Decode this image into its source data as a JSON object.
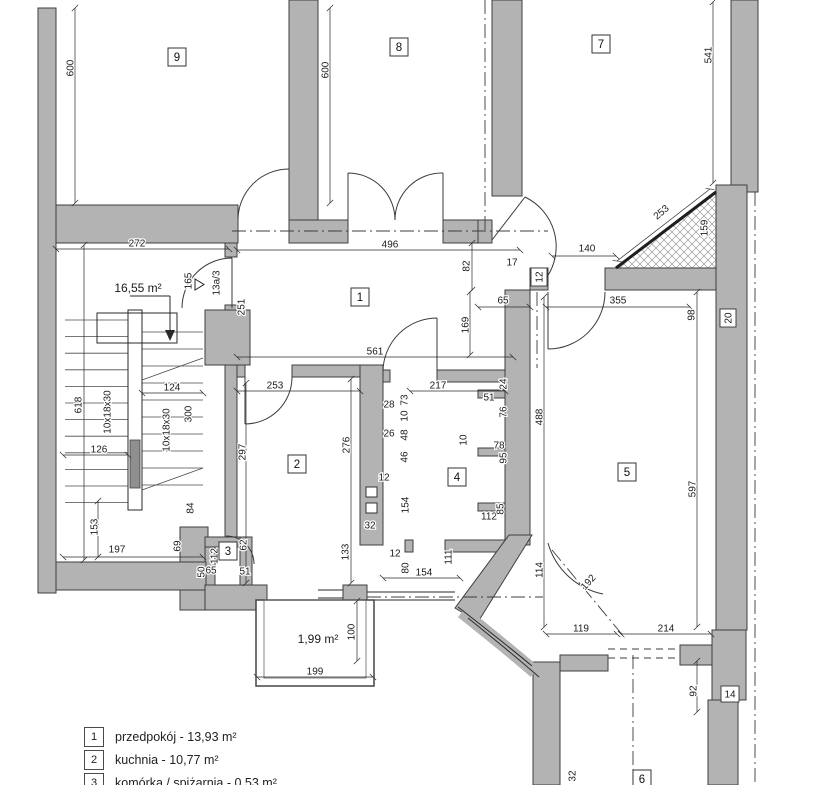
{
  "colors": {
    "wall": "#b3b3b3",
    "wall_outline": "#3f3f3f",
    "line": "#2a2a2a",
    "paper": "#ffffff"
  },
  "areas": [
    {
      "text": "16,55 m²",
      "x": 138,
      "y": 292
    },
    {
      "text": "1,99 m²",
      "x": 318,
      "y": 643
    }
  ],
  "rooms": [
    {
      "num": "9",
      "x": 177,
      "y": 57
    },
    {
      "num": "8",
      "x": 399,
      "y": 47
    },
    {
      "num": "7",
      "x": 601,
      "y": 44
    },
    {
      "num": "1",
      "x": 360,
      "y": 297
    },
    {
      "num": "2",
      "x": 297,
      "y": 464
    },
    {
      "num": "3",
      "x": 228,
      "y": 551
    },
    {
      "num": "4",
      "x": 457,
      "y": 477
    },
    {
      "num": "5",
      "x": 627,
      "y": 472
    },
    {
      "num": "6",
      "x": 642,
      "y": 779
    }
  ],
  "dimensions": [
    {
      "t": "600",
      "x": 70,
      "y": 68,
      "r": -90,
      "line": [
        75,
        8,
        75,
        203
      ]
    },
    {
      "t": "600",
      "x": 325,
      "y": 70,
      "r": -90,
      "line": [
        330,
        8,
        330,
        203
      ]
    },
    {
      "t": "541",
      "x": 708,
      "y": 55,
      "r": -90,
      "line": [
        713,
        2,
        713,
        183
      ]
    },
    {
      "t": "272",
      "x": 137,
      "y": 243,
      "r": 0,
      "line": [
        56,
        249,
        229,
        249
      ]
    },
    {
      "t": "496",
      "x": 390,
      "y": 244,
      "r": 0,
      "line": [
        237,
        250,
        520,
        250
      ]
    },
    {
      "t": "82",
      "x": 466,
      "y": 266,
      "r": -90,
      "line": [
        472,
        243,
        472,
        290
      ]
    },
    {
      "t": "17",
      "x": 512,
      "y": 262,
      "r": 0
    },
    {
      "t": "140",
      "x": 587,
      "y": 248,
      "r": 0,
      "line": [
        552,
        256,
        616,
        256
      ]
    },
    {
      "t": "253",
      "x": 661,
      "y": 212,
      "r": -40,
      "line": [
        617,
        261,
        710,
        189
      ]
    },
    {
      "t": "159",
      "x": 704,
      "y": 228,
      "r": -90
    },
    {
      "t": "12",
      "x": 539,
      "y": 277,
      "r": -90,
      "boxed": true
    },
    {
      "t": "65",
      "x": 503,
      "y": 300,
      "r": 0,
      "line": [
        478,
        307,
        530,
        307
      ]
    },
    {
      "t": "355",
      "x": 618,
      "y": 300,
      "r": 0,
      "line": [
        546,
        307,
        690,
        307
      ]
    },
    {
      "t": "98",
      "x": 691,
      "y": 315,
      "r": -90
    },
    {
      "t": "20",
      "x": 728,
      "y": 318,
      "r": -90,
      "boxed": true
    },
    {
      "t": "165",
      "x": 188,
      "y": 281,
      "r": -90
    },
    {
      "t": "251",
      "x": 241,
      "y": 307,
      "r": -90
    },
    {
      "t": "13a/3",
      "x": 216,
      "y": 283,
      "r": -90
    },
    {
      "t": "169",
      "x": 465,
      "y": 325,
      "r": -90,
      "line": [
        470,
        292,
        470,
        355
      ]
    },
    {
      "t": "561",
      "x": 375,
      "y": 351,
      "r": 0,
      "line": [
        237,
        357,
        513,
        357
      ]
    },
    {
      "t": "618",
      "x": 78,
      "y": 405,
      "r": -90,
      "line": [
        84,
        245,
        84,
        560
      ]
    },
    {
      "t": "10x18x30",
      "x": 107,
      "y": 412,
      "r": -90
    },
    {
      "t": "10x18x30",
      "x": 166,
      "y": 430,
      "r": -90
    },
    {
      "t": "124",
      "x": 172,
      "y": 387,
      "r": 0,
      "line": [
        142,
        393,
        203,
        393
      ]
    },
    {
      "t": "300",
      "x": 188,
      "y": 414,
      "r": -90
    },
    {
      "t": "126",
      "x": 99,
      "y": 449,
      "r": 0,
      "line": [
        63,
        455,
        128,
        455
      ]
    },
    {
      "t": "84",
      "x": 190,
      "y": 508,
      "r": -90
    },
    {
      "t": "153",
      "x": 94,
      "y": 527,
      "r": -90,
      "line": [
        98,
        501,
        98,
        557
      ]
    },
    {
      "t": "197",
      "x": 117,
      "y": 549,
      "r": 0,
      "line": [
        63,
        557,
        203,
        557
      ]
    },
    {
      "t": "69",
      "x": 177,
      "y": 546,
      "r": -90
    },
    {
      "t": "253",
      "x": 275,
      "y": 385,
      "r": 0,
      "line": [
        237,
        391,
        360,
        391
      ]
    },
    {
      "t": "297",
      "x": 242,
      "y": 452,
      "r": -90,
      "line": [
        246,
        383,
        246,
        583
      ]
    },
    {
      "t": "276",
      "x": 346,
      "y": 445,
      "r": -90,
      "line": [
        351,
        379,
        351,
        583
      ]
    },
    {
      "t": "133",
      "x": 345,
      "y": 552,
      "r": -90
    },
    {
      "t": "32",
      "x": 370,
      "y": 525,
      "r": 0
    },
    {
      "t": "28",
      "x": 389,
      "y": 404,
      "r": 0
    },
    {
      "t": "73",
      "x": 404,
      "y": 400,
      "r": -90
    },
    {
      "t": "10",
      "x": 404,
      "y": 416,
      "r": -90
    },
    {
      "t": "26",
      "x": 389,
      "y": 433,
      "r": 0
    },
    {
      "t": "48",
      "x": 404,
      "y": 435,
      "r": -90
    },
    {
      "t": "46",
      "x": 404,
      "y": 457,
      "r": -90
    },
    {
      "t": "12",
      "x": 384,
      "y": 477,
      "r": 0
    },
    {
      "t": "154",
      "x": 405,
      "y": 505,
      "r": -90
    },
    {
      "t": "12",
      "x": 395,
      "y": 553,
      "r": 0
    },
    {
      "t": "80",
      "x": 405,
      "y": 568,
      "r": -90
    },
    {
      "t": "154",
      "x": 424,
      "y": 572,
      "r": 0,
      "line": [
        383,
        578,
        460,
        578
      ]
    },
    {
      "t": "111",
      "x": 448,
      "y": 557,
      "r": -90
    },
    {
      "t": "217",
      "x": 438,
      "y": 385,
      "r": 0,
      "line": [
        410,
        391,
        505,
        391
      ]
    },
    {
      "t": "24",
      "x": 503,
      "y": 384,
      "r": -90
    },
    {
      "t": "51",
      "x": 489,
      "y": 397,
      "r": 0
    },
    {
      "t": "76",
      "x": 503,
      "y": 412,
      "r": -90
    },
    {
      "t": "10",
      "x": 463,
      "y": 440,
      "r": -90
    },
    {
      "t": "78",
      "x": 499,
      "y": 445,
      "r": 0
    },
    {
      "t": "95",
      "x": 503,
      "y": 458,
      "r": -90
    },
    {
      "t": "112",
      "x": 489,
      "y": 516,
      "r": 0
    },
    {
      "t": "85",
      "x": 500,
      "y": 509,
      "r": -90
    },
    {
      "t": "62",
      "x": 243,
      "y": 545,
      "r": -90
    },
    {
      "t": "112",
      "x": 214,
      "y": 556,
      "r": -90
    },
    {
      "t": "65",
      "x": 211,
      "y": 570,
      "r": 0
    },
    {
      "t": "50",
      "x": 201,
      "y": 572,
      "r": -90
    },
    {
      "t": "51",
      "x": 245,
      "y": 571,
      "r": 0
    },
    {
      "t": "488",
      "x": 539,
      "y": 417,
      "r": -90,
      "line": [
        544,
        297,
        544,
        627
      ]
    },
    {
      "t": "597",
      "x": 692,
      "y": 489,
      "r": -90,
      "line": [
        697,
        292,
        697,
        627
      ]
    },
    {
      "t": "100",
      "x": 351,
      "y": 632,
      "r": -90,
      "line": [
        357,
        601,
        357,
        661
      ]
    },
    {
      "t": "199",
      "x": 315,
      "y": 671,
      "r": 0,
      "line": [
        257,
        677,
        373,
        677
      ]
    },
    {
      "t": "114",
      "x": 539,
      "y": 570,
      "r": -90
    },
    {
      "t": "192",
      "x": 588,
      "y": 582,
      "r": -48
    },
    {
      "t": "119",
      "x": 581,
      "y": 628,
      "r": 0,
      "line": [
        546,
        634,
        617,
        634
      ]
    },
    {
      "t": "214",
      "x": 666,
      "y": 628,
      "r": 0,
      "line": [
        621,
        634,
        711,
        634
      ]
    },
    {
      "t": "92",
      "x": 693,
      "y": 691,
      "r": -90,
      "line": [
        697,
        661,
        697,
        712
      ]
    },
    {
      "t": "14",
      "x": 730,
      "y": 694,
      "r": 0,
      "boxed": true
    },
    {
      "t": "32",
      "x": 572,
      "y": 776,
      "r": -90
    }
  ],
  "section_lines": [
    [
      485,
      0,
      485,
      231
    ],
    [
      232,
      231,
      548,
      231
    ],
    [
      755,
      192,
      755,
      785
    ],
    [
      552,
      550,
      625,
      638
    ],
    [
      537,
      292,
      537,
      368
    ],
    [
      367,
      597,
      543,
      597
    ],
    [
      633,
      655,
      633,
      785
    ]
  ],
  "legend": {
    "rows": [
      {
        "num": "1",
        "label": "przedpokój - 13,93 m²"
      },
      {
        "num": "2",
        "label": "kuchnia - 10,77 m²"
      },
      {
        "num": "3",
        "label": "komórka / spiżarnia - 0,53 m²"
      }
    ]
  }
}
